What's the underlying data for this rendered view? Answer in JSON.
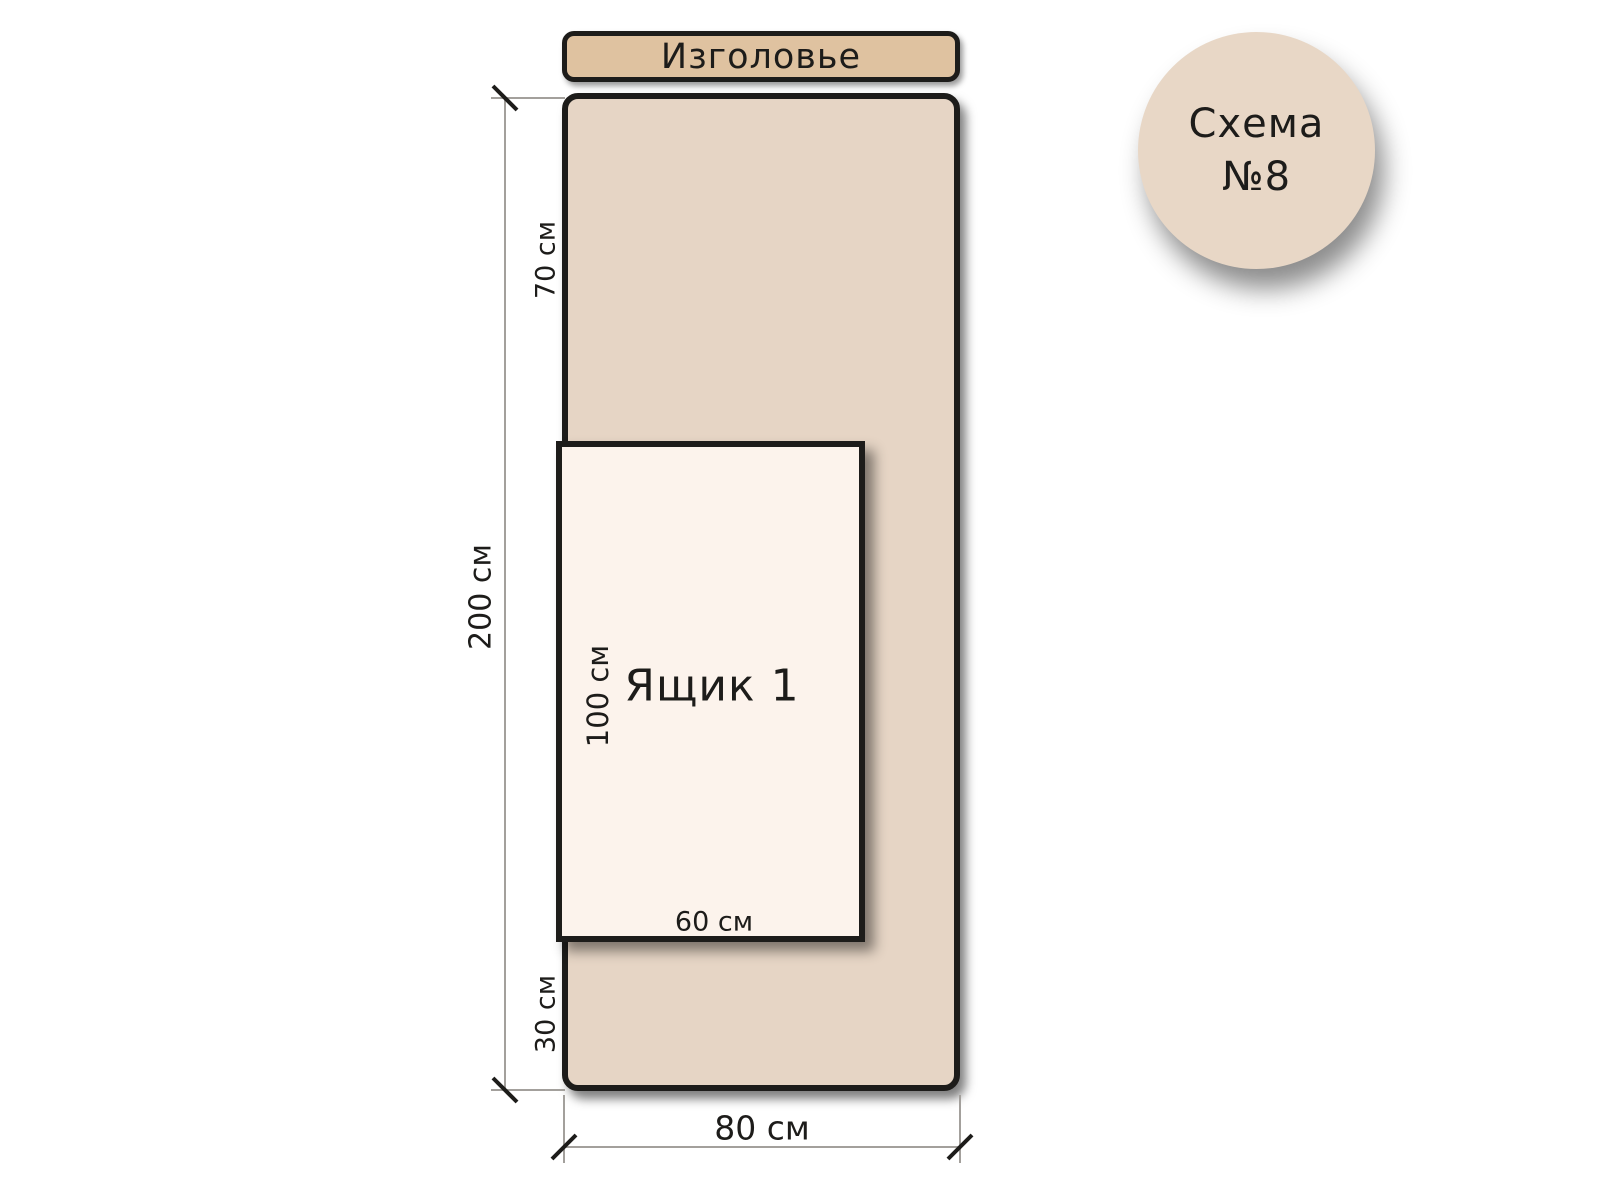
{
  "headboard": {
    "label": "Изголовье"
  },
  "bed": {
    "length_label": "200 см",
    "width_label": "80 см",
    "top_offset_label": "70 см",
    "bottom_offset_label": "30 см"
  },
  "drawer": {
    "label": "Ящик 1",
    "length_label": "100 см",
    "width_label": "60 см"
  },
  "badge": {
    "title": "Схема",
    "number": "№8"
  },
  "measurements_cm": {
    "bed_length": 200,
    "bed_width": 80,
    "drawer_length": 100,
    "drawer_width": 60,
    "head_to_drawer": 70,
    "drawer_to_foot": 30
  },
  "colors": {
    "headboard_fill": "#dfc2a0",
    "bed_fill": "#e6d5c5",
    "drawer_fill": "#fcf3ec",
    "badge_fill": "#e8d7c6",
    "outline": "#1d1c1a",
    "dim_line": "#a3a09c",
    "text": "#1d1c1a"
  }
}
